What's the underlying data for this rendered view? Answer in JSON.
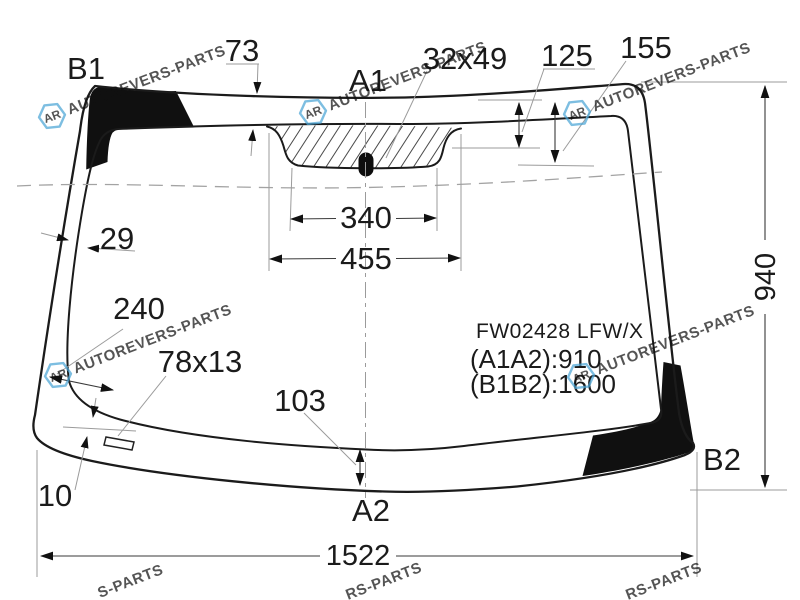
{
  "diagram": {
    "part_code": "FW02428 LFW/X",
    "spec_a": "(A1A2):910",
    "spec_b": "(B1B2):1600",
    "points": {
      "b1": "B1",
      "a1": "A1",
      "b2": "B2",
      "a2": "A2"
    },
    "dims": {
      "top_band": "73",
      "mirror_pad": "32x49",
      "pad_offset_left": "125",
      "pad_offset_right": "155",
      "side_band": "29",
      "bracket_offset": "240",
      "bracket_size": "78x13",
      "bracket_gap": "10",
      "bottom_band": "103",
      "pad_width_inner": "340",
      "pad_width_outer": "455",
      "glass_width": "1522",
      "glass_height": "940"
    }
  },
  "watermark": {
    "logo": "AR",
    "brand": "AUTOREVERS-PARTS",
    "partial_bottom_left": "S-PARTS",
    "partial_bottom_center": "RS-PARTS",
    "partial_bottom_right": "RS-PARTS",
    "color": "#4aa5d6"
  }
}
